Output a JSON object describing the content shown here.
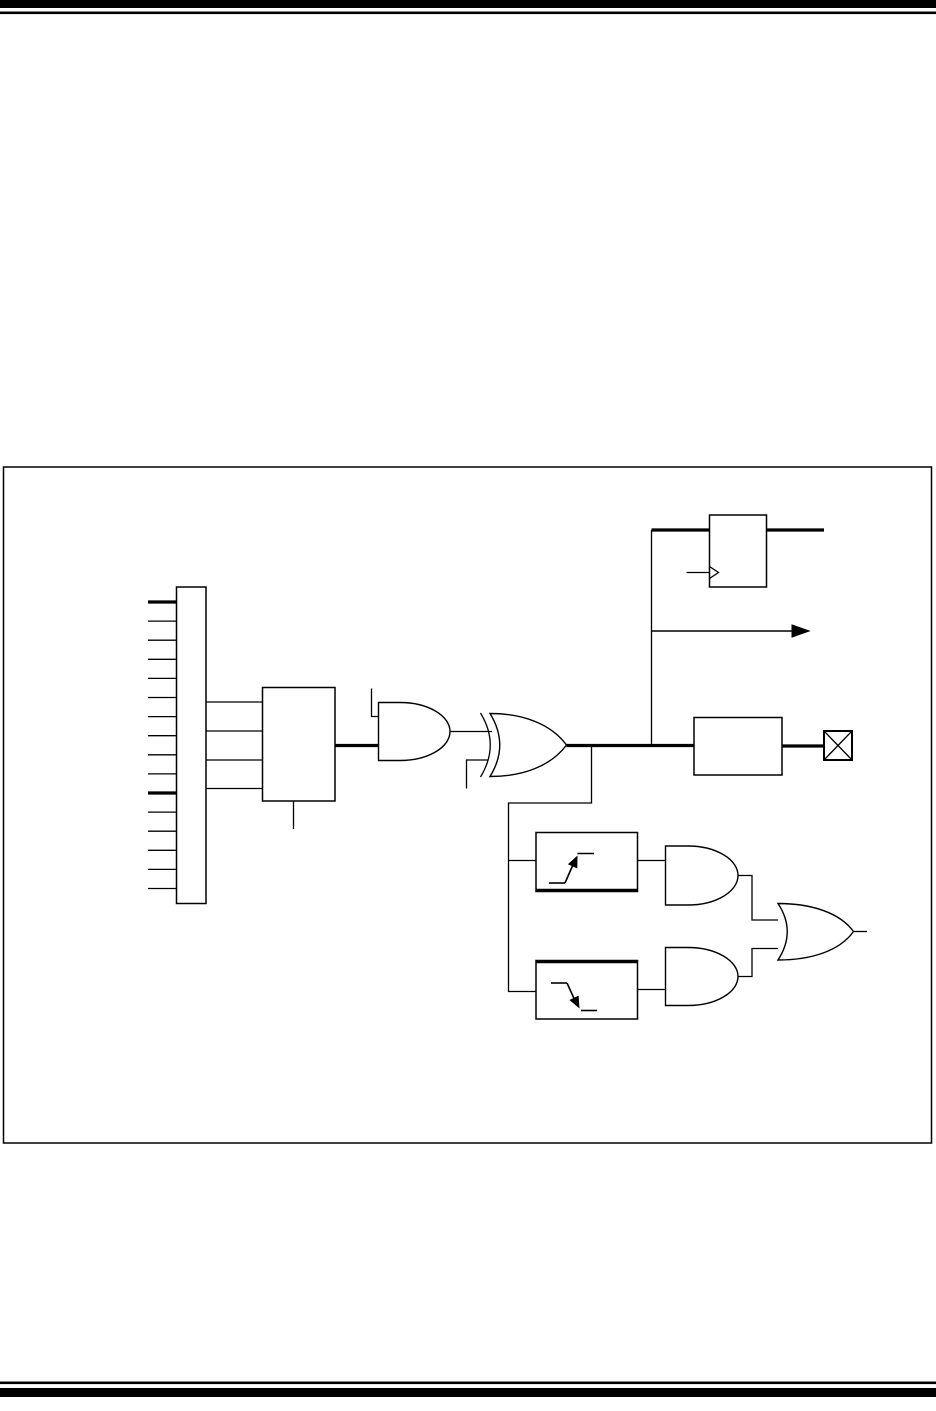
{
  "page": {
    "kind": "datasheet-figure-page",
    "visible_text": [],
    "colors": {
      "ink": "#000000",
      "paper": "#ffffff"
    }
  },
  "diagram": {
    "type": "logic-schematic",
    "description": "Unlabeled I/O port pin block schematic inside a single-line figure frame",
    "input_bus": {
      "kind": "bus-connector",
      "pin_count": 16,
      "bold_pins": [
        1,
        11
      ],
      "pin_side": "left"
    },
    "components": [
      {
        "id": "selector-block",
        "kind": "rectangular-block",
        "inputs": 4,
        "outputs": 1,
        "bottom_stub": true
      },
      {
        "id": "and-gate-1",
        "kind": "and-gate",
        "inputs": 2,
        "top_stub_input": true
      },
      {
        "id": "xor-gate",
        "kind": "xor-gate",
        "inputs": 2,
        "bottom_stub_input": true
      },
      {
        "id": "d-flipflop",
        "kind": "flip-flop-block",
        "clock_wedge": true,
        "through_line": "bold"
      },
      {
        "id": "branch-arrow",
        "kind": "signal-arrow",
        "direction": "right"
      },
      {
        "id": "output-driver-block",
        "kind": "rectangular-block"
      },
      {
        "id": "io-pad",
        "kind": "crossed-square-pad"
      },
      {
        "id": "rising-edge-detector",
        "kind": "edge-detector-block",
        "edge": "rising",
        "bold_edge": "bottom"
      },
      {
        "id": "falling-edge-detector",
        "kind": "edge-detector-block",
        "edge": "falling",
        "bold_edge": "top"
      },
      {
        "id": "and-gate-2",
        "kind": "and-gate",
        "inputs": 1
      },
      {
        "id": "and-gate-3",
        "kind": "and-gate",
        "inputs": 1
      },
      {
        "id": "or-gate",
        "kind": "or-gate",
        "inputs": 2
      }
    ]
  }
}
